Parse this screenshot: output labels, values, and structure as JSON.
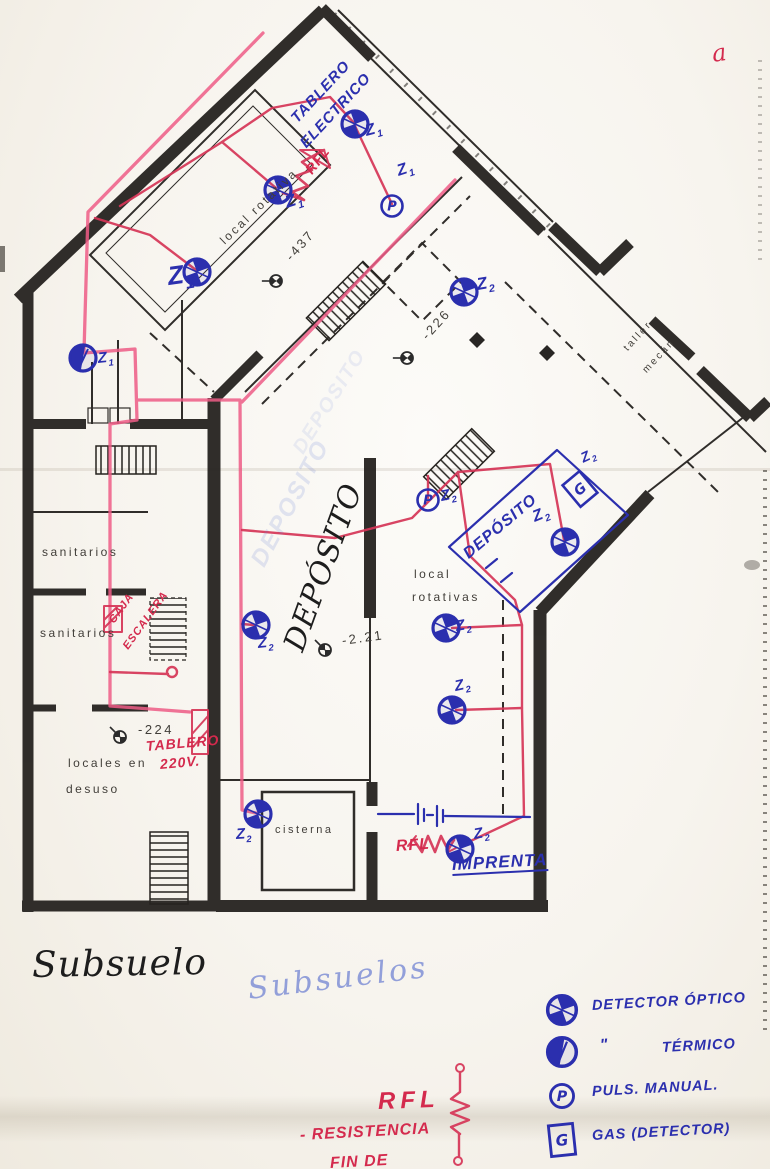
{
  "titles": {
    "floor_black": "Subsuelo",
    "floor_blue": "Subsuelos",
    "corner_mark": "a"
  },
  "rooms": [
    {
      "name": "room-label-local-rotativa",
      "text": "local rotativa",
      "x": 222,
      "y": 242,
      "rot": -44,
      "size": 12
    },
    {
      "name": "room-label-sanitarios-upper",
      "text": "sanitarios",
      "x": 42,
      "y": 552,
      "rot": 0,
      "size": 12
    },
    {
      "name": "room-label-sanitarios-lower",
      "text": "sanitarios",
      "x": 40,
      "y": 633,
      "rot": 0,
      "size": 12
    },
    {
      "name": "room-label-locales-1",
      "text": "locales en",
      "x": 68,
      "y": 763,
      "rot": 0,
      "size": 12
    },
    {
      "name": "room-label-locales-2",
      "text": "desuso",
      "x": 66,
      "y": 789,
      "rot": 0,
      "size": 12
    },
    {
      "name": "room-label-cisterna",
      "text": "cisterna",
      "x": 275,
      "y": 830,
      "rot": 0,
      "size": 11
    },
    {
      "name": "room-label-rotativas-1",
      "text": "local",
      "x": 414,
      "y": 574,
      "rot": 0,
      "size": 12
    },
    {
      "name": "room-label-rotativas-2",
      "text": "rotativas",
      "x": 412,
      "y": 597,
      "rot": 0,
      "size": 12
    },
    {
      "name": "room-label-taller-1",
      "text": "taller",
      "x": 626,
      "y": 350,
      "rot": -47,
      "size": 10
    },
    {
      "name": "room-label-taller-2",
      "text": "mecán",
      "x": 645,
      "y": 372,
      "rot": -47,
      "size": 10
    }
  ],
  "levels": [
    {
      "text": "-437",
      "x": 288,
      "y": 258,
      "rot": -48,
      "sx": 276,
      "sy": 281,
      "srot": -45
    },
    {
      "text": "-226",
      "x": 424,
      "y": 337,
      "rot": -48,
      "sx": 407,
      "sy": 358,
      "srot": -45
    },
    {
      "text": "-2.21",
      "x": 342,
      "y": 640,
      "rot": -8,
      "sx": 325,
      "sy": 650,
      "srot": 0
    },
    {
      "text": "-224",
      "x": 138,
      "y": 729,
      "rot": 0,
      "sx": 120,
      "sy": 737,
      "srot": 0
    }
  ],
  "notes_blue": [
    {
      "name": "note-tablero-electrico-1",
      "text": "TABLERO",
      "x": 294,
      "y": 120,
      "rot": -47,
      "size": 15
    },
    {
      "name": "note-tablero-electrico-2",
      "text": "ELECTRICO",
      "x": 303,
      "y": 145,
      "rot": -47,
      "size": 15
    },
    {
      "name": "note-deposito-room",
      "text": "DEPÓSITO",
      "x": 466,
      "y": 556,
      "rot": -40,
      "size": 16
    },
    {
      "name": "note-imprenta",
      "text": "IMPRENTA",
      "x": 452,
      "y": 864,
      "rot": -3,
      "size": 17,
      "underline": true
    }
  ],
  "notes_red": [
    {
      "name": "note-rfl-top",
      "text": "RFL",
      "x": 308,
      "y": 172,
      "rot": -52,
      "size": 14
    },
    {
      "name": "note-caja-escalera-1",
      "text": "CAJA",
      "x": 112,
      "y": 622,
      "rot": -54,
      "size": 11
    },
    {
      "name": "note-caja-escalera-2",
      "text": "ESCALERA",
      "x": 126,
      "y": 648,
      "rot": -54,
      "size": 11
    },
    {
      "name": "note-tablero-220v-1",
      "text": "TABLERO",
      "x": 146,
      "y": 746,
      "rot": -5,
      "size": 14
    },
    {
      "name": "note-tablero-220v-2",
      "text": "220V.",
      "x": 160,
      "y": 764,
      "rot": -5,
      "size": 14
    },
    {
      "name": "note-rfl-imprenta",
      "text": "RFL",
      "x": 396,
      "y": 847,
      "rot": -4,
      "size": 16
    }
  ],
  "ghost_notes": [
    {
      "text": "DEPOSITO",
      "x": 298,
      "y": 452,
      "rot": -58,
      "size": 20,
      "op": 0.3
    },
    {
      "text": "DEPOSITO",
      "x": 258,
      "y": 565,
      "rot": -62,
      "size": 24,
      "op": 0.45
    }
  ],
  "big_script": {
    "text": "DEPÓSITO",
    "x": 294,
    "y": 650,
    "rot": -70,
    "size": 30
  },
  "detectors": [
    {
      "type": "optical",
      "x": 278,
      "y": 190
    },
    {
      "type": "optical",
      "x": 197,
      "y": 272
    },
    {
      "type": "optical",
      "x": 355,
      "y": 124
    },
    {
      "type": "pulsador",
      "x": 392,
      "y": 206
    },
    {
      "type": "thermal",
      "x": 83,
      "y": 358
    },
    {
      "type": "optical",
      "x": 464,
      "y": 292
    },
    {
      "type": "pulsador",
      "x": 428,
      "y": 500
    },
    {
      "type": "optical",
      "x": 565,
      "y": 542
    },
    {
      "type": "gas",
      "x": 580,
      "y": 489,
      "rot": -40
    },
    {
      "type": "optical",
      "x": 256,
      "y": 625
    },
    {
      "type": "optical",
      "x": 446,
      "y": 628
    },
    {
      "type": "optical",
      "x": 452,
      "y": 710
    },
    {
      "type": "optical",
      "x": 258,
      "y": 814
    },
    {
      "type": "optical",
      "x": 460,
      "y": 849
    }
  ],
  "zone_labels": [
    {
      "zone": "Z1",
      "x": 286,
      "y": 202,
      "rot": -18,
      "size": 17
    },
    {
      "zone": "Z1",
      "x": 168,
      "y": 276,
      "rot": -8,
      "size": 26
    },
    {
      "zone": "Z1",
      "x": 366,
      "y": 132,
      "rot": -15,
      "size": 16
    },
    {
      "zone": "Z1",
      "x": 398,
      "y": 172,
      "rot": -18,
      "size": 16
    },
    {
      "zone": "Z1",
      "x": 98,
      "y": 358,
      "rot": -6,
      "size": 15
    },
    {
      "zone": "Z2",
      "x": 477,
      "y": 284,
      "rot": -10,
      "size": 17
    },
    {
      "zone": "Z2",
      "x": 441,
      "y": 496,
      "rot": -12,
      "size": 15
    },
    {
      "zone": "Z2",
      "x": 534,
      "y": 518,
      "rot": -22,
      "size": 16
    },
    {
      "zone": "Z2",
      "x": 582,
      "y": 458,
      "rot": -25,
      "size": 14
    },
    {
      "zone": "Z2",
      "x": 258,
      "y": 643,
      "rot": -6,
      "size": 15
    },
    {
      "zone": "Z2",
      "x": 456,
      "y": 626,
      "rot": -10,
      "size": 15
    },
    {
      "zone": "Z2",
      "x": 455,
      "y": 686,
      "rot": -12,
      "size": 15
    },
    {
      "zone": "Z2",
      "x": 236,
      "y": 834,
      "rot": -4,
      "size": 15
    },
    {
      "zone": "Z2",
      "x": 474,
      "y": 834,
      "rot": -10,
      "size": 15
    }
  ],
  "legend": {
    "items": [
      {
        "symbol": "optical",
        "prefix": "",
        "label": "DETECTOR ÓPTICO"
      },
      {
        "symbol": "thermal",
        "prefix": "\"",
        "label": "TÉRMICO"
      },
      {
        "symbol": "pulsador",
        "prefix": "",
        "label": "PULS. MANUAL."
      },
      {
        "symbol": "gas",
        "prefix": "",
        "label": "GAS (DETECTOR)"
      }
    ]
  },
  "rfl_note": {
    "abbr": "RFL",
    "line1": "- RESISTENCIA",
    "line2": "FIN DE"
  },
  "ink_colors": {
    "blue": "#2b2fae",
    "red": "#d63557",
    "pink": "#ee5c86",
    "pencil": "#413e39"
  }
}
